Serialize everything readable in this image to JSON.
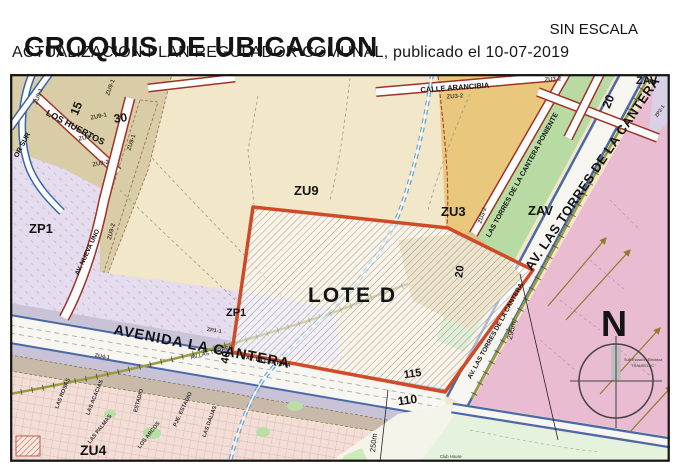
{
  "header": {
    "title": "CROQUIS DE UBICACION",
    "scale_note": "SIN ESCALA",
    "subtitle": "ACTUALIZACION PLAN REGULADOR COMUNAL, publicado el 10-07-2019"
  },
  "map": {
    "zones": {
      "zu9": "ZU9",
      "zu3": "ZU3",
      "zav": "ZAV",
      "zav_top": "ZAV",
      "zp1_left": "ZP1",
      "zp1_small": "ZP1",
      "zu4": "ZU4",
      "lote": "LOTE D"
    },
    "subzones": {
      "zu9_1": "ZU9-1",
      "zu9_2": "ZU9-2",
      "zu3_2": "ZU3-2",
      "zu4_1": "ZU4-1",
      "zp1_1": "ZP1-1",
      "zp2_1": "ZP2-1"
    },
    "streets": {
      "los_huertos": "LOS HUERTOS",
      "av_nueva_uno": "AV. NUEVA UNO",
      "or_sur": "OR SUR",
      "avenida_la_cantera": "AVENIDA LA CANTERA",
      "av_la_cantera": "AV. LA CANTERA",
      "av_las_torres": "AV LAS TORRES",
      "av_las_torres_de_la_cantera": "AV. LAS TORRES DE LA CANTERA",
      "poniente": "LAS TORRES DE LA CANTERA PONIENTE",
      "arancibia": "CALLE ARANCIBIA",
      "las_rosas": "LAS ROSAS",
      "las_acacias": "LAS ACACIAS",
      "las_palmas": "LAS PALMAS",
      "estadio": "ESTADIO",
      "los_arcos": "LOS ARCOS",
      "pje_estadio": "PJE. ESTADIO",
      "las_dalias": "LAS DALIAS"
    },
    "widths": {
      "w15": "15",
      "w30": "30",
      "w20": "20",
      "w40": "40",
      "w110": "110",
      "w115": "115"
    },
    "dimensions": {
      "d295": "295m",
      "d250": "250m"
    },
    "compass": {
      "north": "N"
    },
    "notes": {
      "substation_line1": "Sub-Estación Eléctrica",
      "substation_line2": "\"TRANSELEC\"",
      "club_house": "Club House"
    },
    "colors": {
      "lote_boundary": "#d14a28",
      "road_blue": "#4a69a8",
      "road_red": "#a03226",
      "zone_beige": "#f2e7c9",
      "zone_khaki": "#d8cda6",
      "zone_purple": "#e5dcee",
      "zone_green": "#b7dba2",
      "zone_tan": "#e9c77c",
      "zone_pink": "#e9bcd2",
      "residential_pink": "#f3ded7",
      "corner_green": "#e4f2de",
      "stream_blue": "#69a1cf",
      "railway_olive": "#9b9c41"
    }
  }
}
